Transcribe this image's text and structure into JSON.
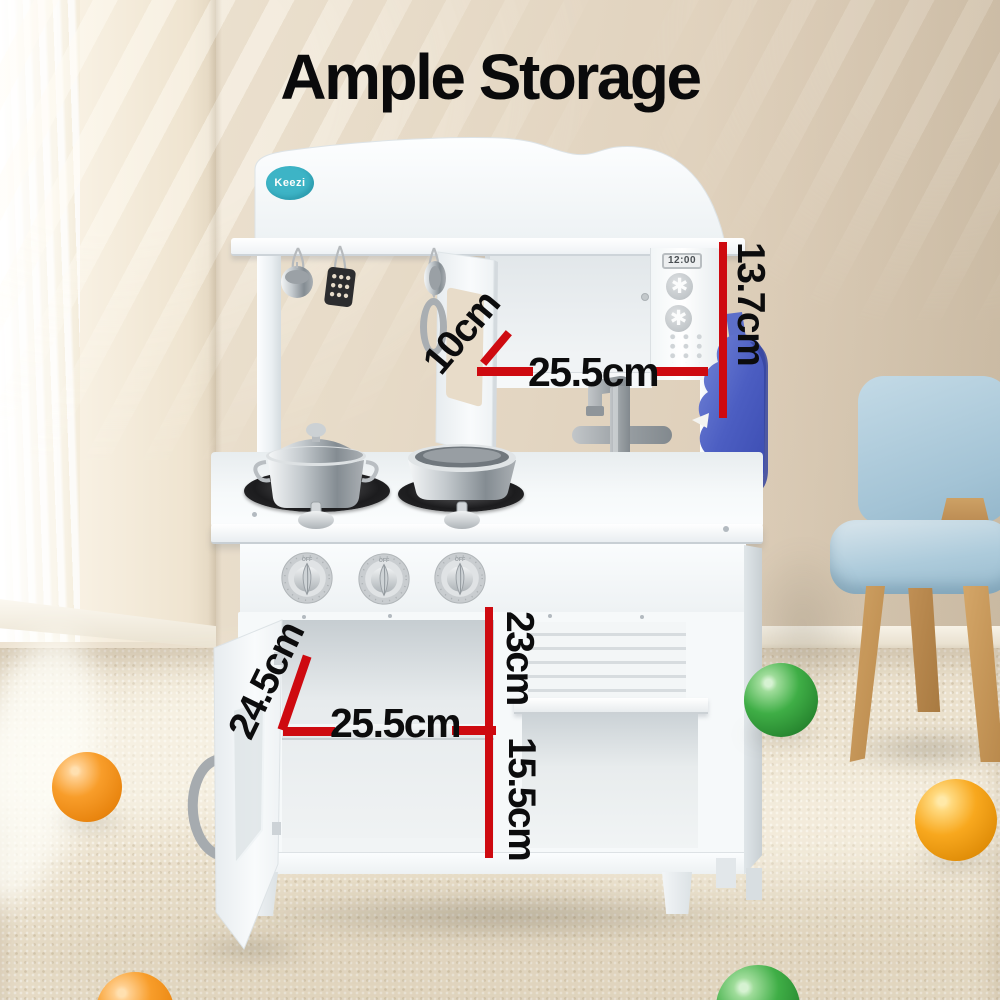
{
  "title": "Ample Storage",
  "brand": {
    "logo_text": "Keezi"
  },
  "microwave": {
    "clock_display": "12:00"
  },
  "stove": {
    "knob_label": "OFF",
    "knob_count": 3
  },
  "annotations": {
    "microwave_height": "13.7cm",
    "top_door_depth": "10cm",
    "top_cabinet_width": "25.5cm",
    "middle_shelf_height": "23cm",
    "lower_door_height": "24.5cm",
    "lower_cabinet_width": "25.5cm",
    "bottom_shelf_height": "15.5cm"
  },
  "colors": {
    "annotation_line_red": "#ce0a10",
    "annotation_text_black": "#0c0c0d",
    "kitchen_white": "#f6f9fa",
    "mitt_blue": "#4c5ec2",
    "chair_seat_blue": "#abc9da",
    "chair_leg_wood": "#c79a5e",
    "ball_orange": "#f89d2a",
    "ball_green": "#3fae46",
    "ball_yellow_orange": "#f8a81e",
    "logo_teal": "#3db4c6"
  }
}
